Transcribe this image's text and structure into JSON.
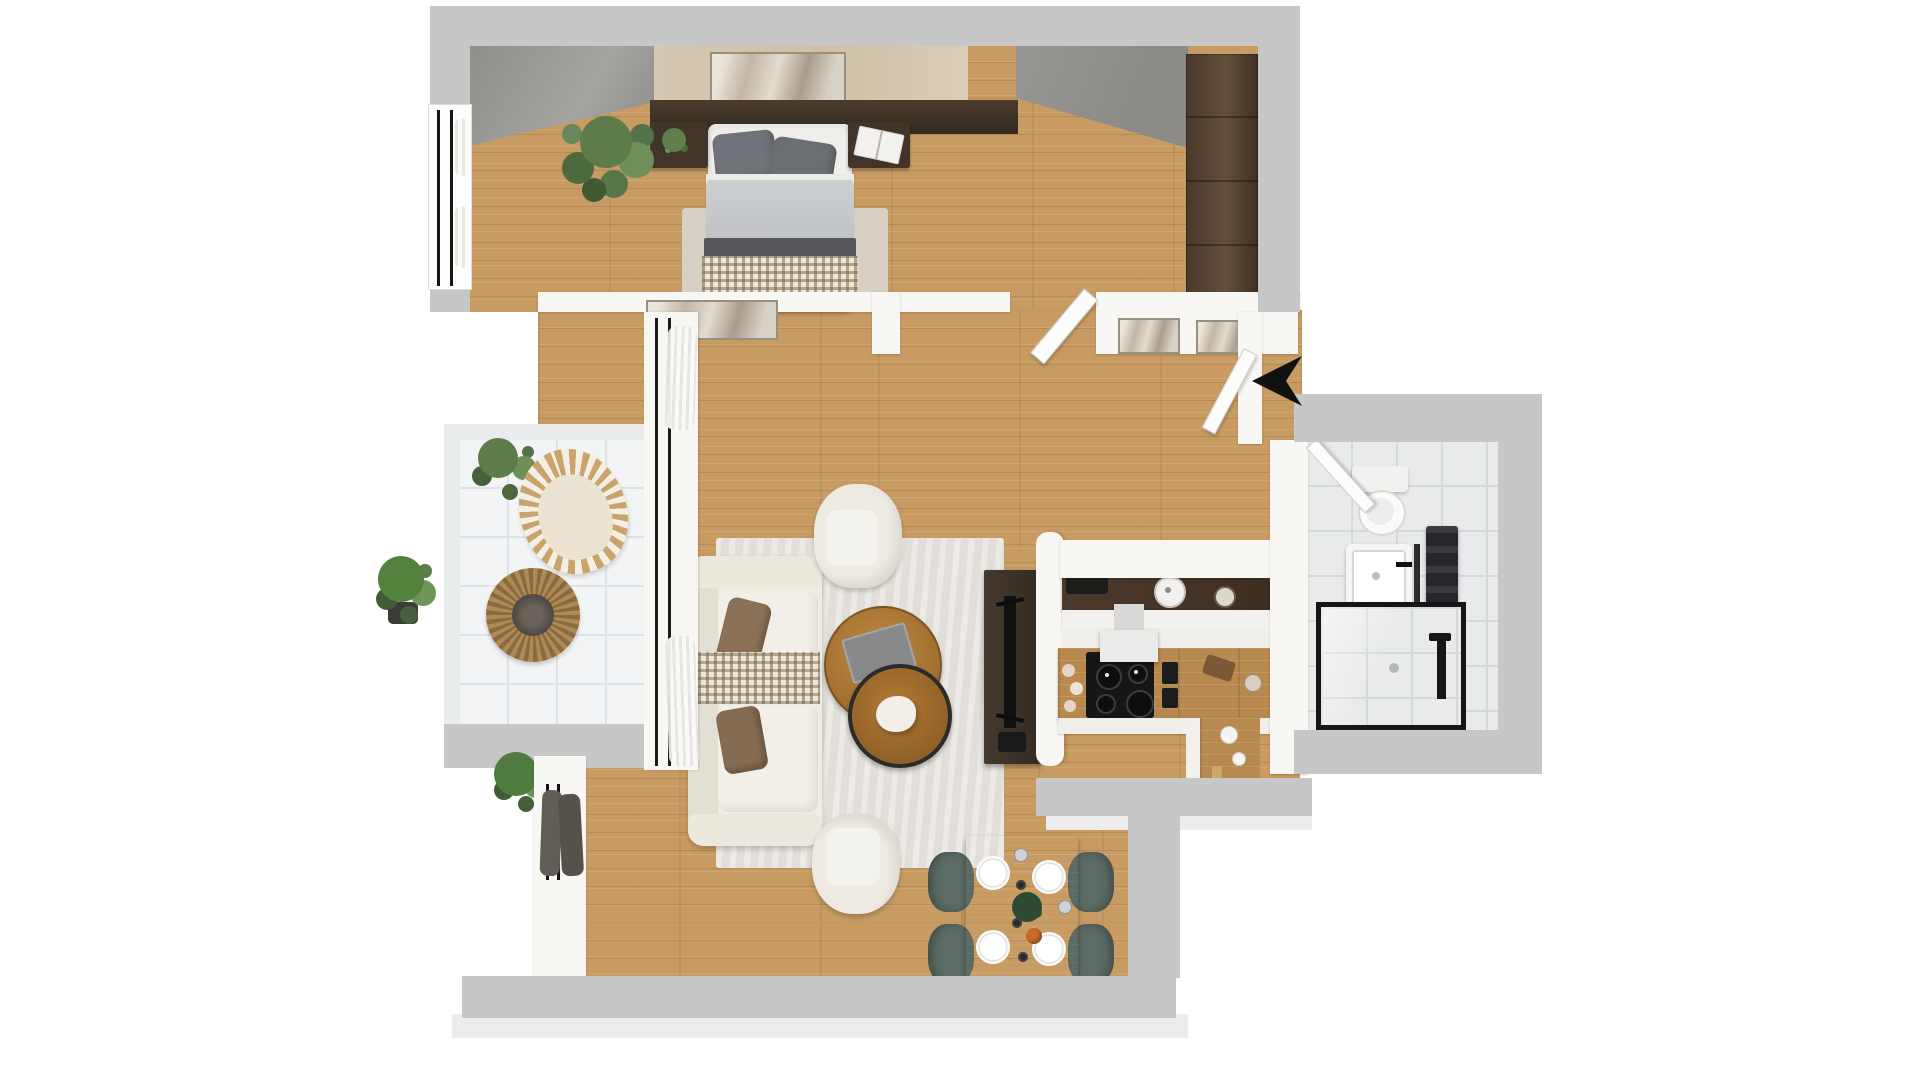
{
  "meta": {
    "title": "3D rendered top-down floor plan of a one-bedroom apartment",
    "style": "photoreal 3D render, no text labels",
    "background": "#ffffff"
  },
  "palette": {
    "pageBg": "#ffffff",
    "wood": "#c89b63",
    "counterWood": "#b8894f",
    "wallGray": "#c6c7c6",
    "wallGrayLight": "#ececec",
    "wallWhite": "#f8f7f4",
    "concrete": "#8f8e8b",
    "travertine": "#d6c9b1",
    "headboard": "#3e3228",
    "wardrobe": "#53412f",
    "sofa": "#efece4",
    "sofaShade": "#e3dfd4",
    "rug": "#e2dfd8",
    "rugBedroom": "#d7d1c5",
    "duvet": "#c6c8ca",
    "blanket": "#54565a",
    "pillowGray": "#70747a",
    "pillowBrown": "#8a7157",
    "throwBeige": "#d9d0bc",
    "plantGreen": "#5d7c49",
    "plantDark": "#46603c",
    "wicker": "#c9a46c",
    "balconyTile": "#f3f4f5",
    "tileLine": "#dfe3e5",
    "bathTile": "#e8eaeb",
    "bathTileLine": "#d6d9da",
    "chairTeal": "#5c6b65",
    "tableWalnut": "#413227",
    "counterDark": "#463527",
    "cooktopBlack": "#161616",
    "applianceBlack": "#1f1d1b",
    "curtainDark": "#615d56",
    "arrowBlack": "#111111",
    "accentOrange": "#c96a2a"
  },
  "rooms": {
    "bedroom": {
      "name": "bedroom"
    },
    "living": {
      "name": "living-room"
    },
    "kitchen": {
      "name": "kitchen"
    },
    "hallway": {
      "name": "hallway"
    },
    "bathroom": {
      "name": "bathroom"
    },
    "balcony": {
      "name": "balcony"
    }
  },
  "furniture": {
    "bedroom": [
      "double-bed",
      "gray-pillows",
      "checkered-throw",
      "nightstand-left-with-plant",
      "nightstand-right-with-book",
      "tall-plant",
      "wardrobe",
      "bed-rug",
      "wall-art",
      "concrete-accent-wall",
      "stone-headboard-wall",
      "window-with-curtains"
    ],
    "living": [
      "white-sofa",
      "brown-pillows",
      "checkered-blanket",
      "armchair-north",
      "armchair-south",
      "nesting-coffee-tables",
      "area-rug",
      "tv-on-stand",
      "dining-table",
      "dining-chairs",
      "wall-art",
      "floor-plant",
      "window-with-dark-curtains"
    ],
    "kitchen": [
      "dark-worktop-with-kettle",
      "coffee-machine",
      "induction-cooktop",
      "range-hood",
      "wood-counter",
      "spice-grinders",
      "cutting-board",
      "garlic-bulbs",
      "half-wall-partition"
    ],
    "hallway": [
      "two-framed-artworks",
      "open-doors"
    ],
    "bathroom": [
      "toilet",
      "square-sink-vanity",
      "towel-radiator",
      "black-framed-walk-in-shower"
    ],
    "balcony": [
      "rattan-armchair",
      "round-rattan-table",
      "potted-plants",
      "white-floor-tiles"
    ]
  },
  "counts": {
    "dining_chairs": 4,
    "dinner_plates": 4,
    "cooktop_burners": 4,
    "hallway_artworks": 2
  },
  "compass": {
    "arrow_direction": "pointing-left"
  }
}
